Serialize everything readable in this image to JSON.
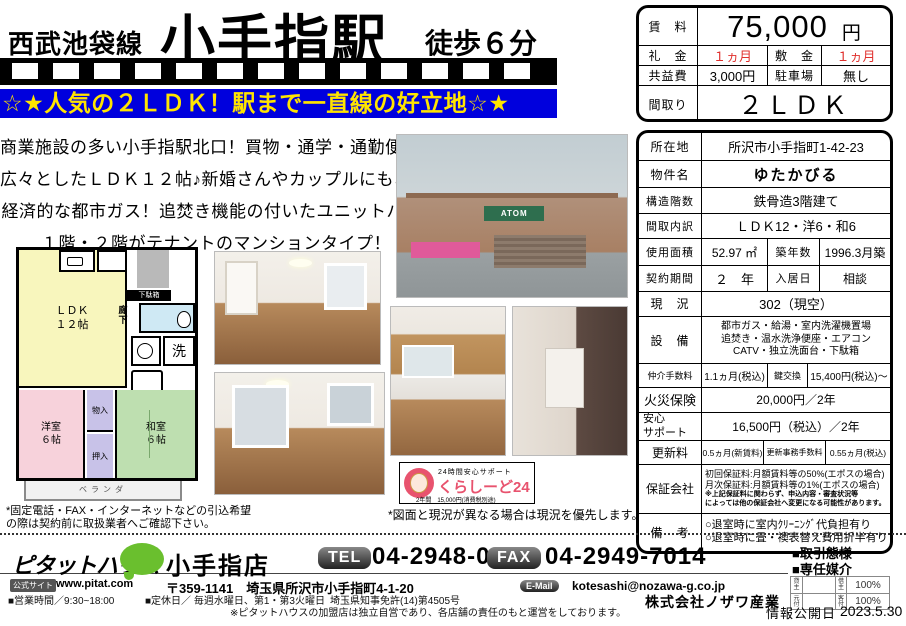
{
  "colors": {
    "banner_bg": "#0000dd",
    "banner_text": "#ffe400",
    "accent_red": "#e0312e",
    "logo_green": "#6abf2e"
  },
  "header": {
    "line_name": "西武池袋線",
    "station": "小手指駅",
    "walk": "徒歩６分",
    "catch": "☆★人気の２ＬＤＫ！駅まで一直線の好立地☆★"
  },
  "price_table": {
    "rent_label": "賃　料",
    "rent_value": "75,000",
    "rent_unit": "円",
    "reikin_label": "礼　金",
    "reikin_value": "１ヵ月",
    "shikikin_label": "敷　金",
    "shikikin_value": "１ヵ月",
    "kyoeki_label": "共益費",
    "kyoeki_value": "3,000円",
    "parking_label": "駐車場",
    "parking_value": "無し",
    "madori_label": "間取り",
    "madori_value": "２ＬＤＫ"
  },
  "description": {
    "line1": "商業施設の多い小手指駅北口！買物・通学・通勤便利！",
    "line2": "広々としたＬＤＫ１２帖♪新婚さんやカップルにもおススメ！",
    "line3": "経済的な都市ガス！追焚き機能の付いたユニットバス♪",
    "line4": "１階・２階がテナントのマンションタイプ！"
  },
  "floorplan": {
    "ldk": "ＬＤＫ",
    "ldk_size": "１２帖",
    "rouka": "廊下",
    "getabako": "下駄箱",
    "laundry": "洗",
    "yoshitsu": "洋室",
    "yoshitsu_size": "６帖",
    "mono": "物入",
    "oshiire": "押入",
    "washitsu": "和室",
    "washitsu_size": "６帖",
    "veranda": "ベランダ"
  },
  "photos": {
    "exterior_sign": "ATOM"
  },
  "details": {
    "address_label": "所在地",
    "address": "所沢市小手指町1-42-23",
    "name_label": "物件名",
    "name": "ゆたかびる",
    "structure_label": "構造階数",
    "structure": "鉄骨造3階建て",
    "layout_label": "間取内訳",
    "layout": "ＬＤＫ12・洋6・和6",
    "area_label": "使用面積",
    "area": "52.97 ㎡",
    "built_label": "築年数",
    "built": "1996.3月築",
    "term_label": "契約期間",
    "term": "２　年",
    "movein_label": "入居日",
    "movein": "相談",
    "status_label": "現　況",
    "status": "302（現空）",
    "equip_label": "設　備",
    "equip1": "都市ガス・給湯・室内洗濯機置場",
    "equip2": "追焚き・温水洗浄便座・エアコン",
    "equip3": "CATV・独立洗面台・下駄箱",
    "fee_label": "仲介手数料",
    "fee": "1.1ヵ月(税込)",
    "key_label": "鍵交換",
    "key": "15,400円(税込)～",
    "fire_label": "火災保険",
    "fire": "20,000円／2年",
    "support_label1": "安心",
    "support_label2": "サポート",
    "support": "16,500円（税込）／2年",
    "renewal_label": "更新料",
    "renewal": "0.5ヵ月(新賃料)",
    "renewal_fee_label": "更新事務手数料",
    "renewal_fee": "0.55ヵ月(税込)",
    "guarantor_label": "保証会社",
    "guarantor1": "初回保証料:月額賃料等の50%(エポスの場合)",
    "guarantor2": "月次保証料:月額賃料等の1%(エポスの場合)",
    "guarantor3": "※上記保証料に関わらず、申込内容・審査状況等",
    "guarantor4": "によっては他の保証会社へ変更になる可能性があります。",
    "notes_label": "備　考",
    "notes1": "○退室時に室内ｸﾘｰﾆﾝｸﾞ代負担有り",
    "notes2": "○退室時に畳・襖表替え費用折半有り"
  },
  "badge24": {
    "line1": "24時間安心サポート",
    "line2": "くらしーど24",
    "line3": "2年間　15,000円(消費税別途)"
  },
  "notes": {
    "left1": "*固定電話・FAX・インターネットなどの引込希望",
    "left2": "の際は契約前に取扱業者へご確認下さい。",
    "right": "*図面と現況が異なる場合は現況を優先します。"
  },
  "footer": {
    "logo": "ピタットハウス",
    "site_label": "公式サイト",
    "site_url": "www.pitat.com",
    "shop": "小手指店",
    "shop_address": "〒359-1141　埼玉県所沢市小手指町4-1-20",
    "tel_label": "TEL",
    "tel": "04-2948-0110",
    "fax_label": "FAX",
    "fax": "04-2949-7014",
    "email_label": "E-Mail",
    "email": "kotesashi@nozawa-g.co.jp",
    "company": "株式会社ノザワ産業",
    "deal_type_label": "■取引態様",
    "deal_type_value": "■専任媒介",
    "matrix": {
      "r1c1": "貸主",
      "r1v1": "",
      "r1c2": "借主",
      "r1v2": "100%",
      "r2c1": "元付",
      "r2v1": "",
      "r2c2": "客付",
      "r2v2": "100%"
    },
    "open_label": "情報公開日",
    "open_date": "2023.5.30",
    "hours": "■営業時間／9:30~18:00",
    "holiday": "■定休日／ 毎週水曜日、第1・第3火曜日",
    "license": "埼玉県知事免許(14)第4505号",
    "disclaimer": "※ピタットハウスの加盟店は独立自営であり、各店舗の責任のもと運営をしております。"
  }
}
